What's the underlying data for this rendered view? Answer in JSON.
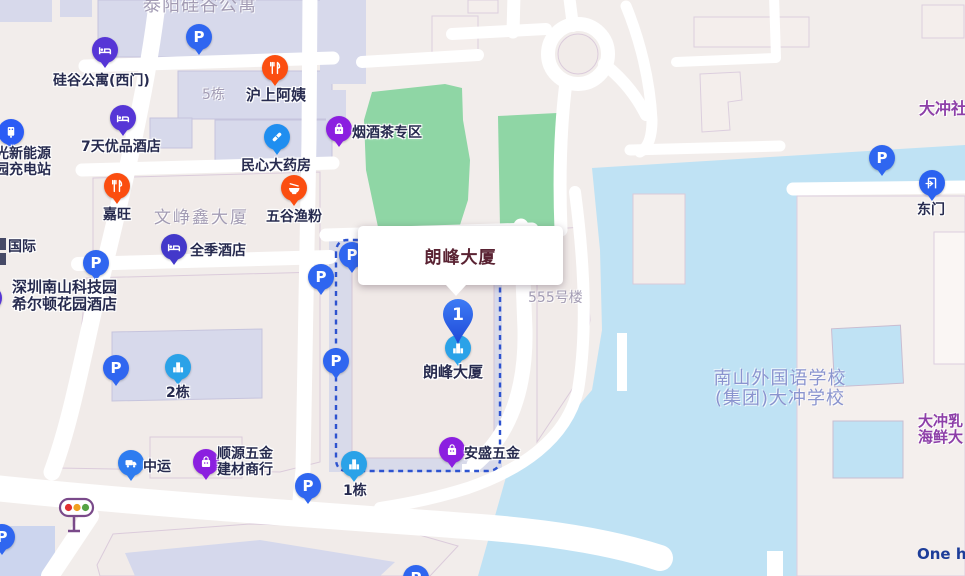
{
  "app": {
    "type": "web-map",
    "view": "place-detail"
  },
  "selected": {
    "marker_number": "1",
    "infobox_title": "朗峰大厦",
    "poi_label": "朗峰大厦"
  },
  "icons": {
    "parking_glyph": "P",
    "parking_count": 10,
    "types": [
      "parking-icon",
      "hotel-icon",
      "restaurant-icon",
      "noodle-bowl-icon",
      "pharmacy-icon",
      "shop-icon",
      "truck-icon",
      "building-icon",
      "charging-station-icon",
      "gate-icon",
      "traffic-light-icon",
      "marker-pin"
    ]
  },
  "pois": [
    {
      "type": "hotel",
      "label": "硅谷公寓(西门)"
    },
    {
      "type": "hotel",
      "label": "7天优品酒店"
    },
    {
      "type": "hotel",
      "label": "全季酒店"
    },
    {
      "type": "hotel",
      "lines": [
        "深圳南山科技园",
        "希尔顿花园酒店"
      ]
    },
    {
      "type": "restaurant",
      "label": "沪上阿姨"
    },
    {
      "type": "restaurant",
      "label": "嘉旺"
    },
    {
      "type": "restaurant",
      "label": "五谷渔粉"
    },
    {
      "type": "pharmacy",
      "label": "民心大药房"
    },
    {
      "type": "shop",
      "label": "烟酒茶专区"
    },
    {
      "type": "shop",
      "lines": [
        "顺源五金",
        "建材商行"
      ]
    },
    {
      "type": "shop",
      "label": "安盛五金"
    },
    {
      "type": "logistics",
      "label": "中运"
    },
    {
      "type": "building",
      "label": "2栋"
    },
    {
      "type": "building",
      "label": "1栋"
    },
    {
      "type": "building",
      "label": "朗峰大厦"
    },
    {
      "type": "charging",
      "lines": [
        "光新能源",
        "园充电站"
      ]
    },
    {
      "type": "gate",
      "label": "东门"
    }
  ],
  "labels": [
    {
      "text": "泰阳硅谷公寓"
    },
    {
      "text": "5栋"
    },
    {
      "text": "文峥鑫大厦"
    },
    {
      "text": "555号楼"
    },
    {
      "text": "国际"
    },
    {
      "lines": [
        "南山外国语学校",
        "(集团)大冲学校"
      ]
    },
    {
      "text": "大冲社"
    },
    {
      "lines": [
        "大冲乳",
        "海鲜大"
      ]
    },
    {
      "text": "One ha"
    }
  ],
  "colors": {
    "land": "#f2edeb",
    "water": "#bfe2f4",
    "park_green": "#8fd6a5",
    "building_lavender": "#d7d9eb",
    "building_beige": "#f1ebe9",
    "road": "#ffffff",
    "route_dash": "#2d53cf",
    "marker_blue": "#2b5ae8",
    "parking_blue": "#2f66f0",
    "hotel_indigo": "#5636d6",
    "restaurant_orange": "#fb4e10",
    "pharmacy_blue": "#1f8ef0",
    "shop_purple": "#8b1fe0",
    "truck_blue": "#2e7cf0",
    "building_icon_blue": "#2aa2e8",
    "poi_label_dark": "#272b4f",
    "area_label_gray": "#a39cb4",
    "school_label_blue": "#8a94cf",
    "district_label_purple": "#8d3fa8",
    "infobox_title_maroon": "#5a2333",
    "english_label_blue": "#1d3d99"
  }
}
